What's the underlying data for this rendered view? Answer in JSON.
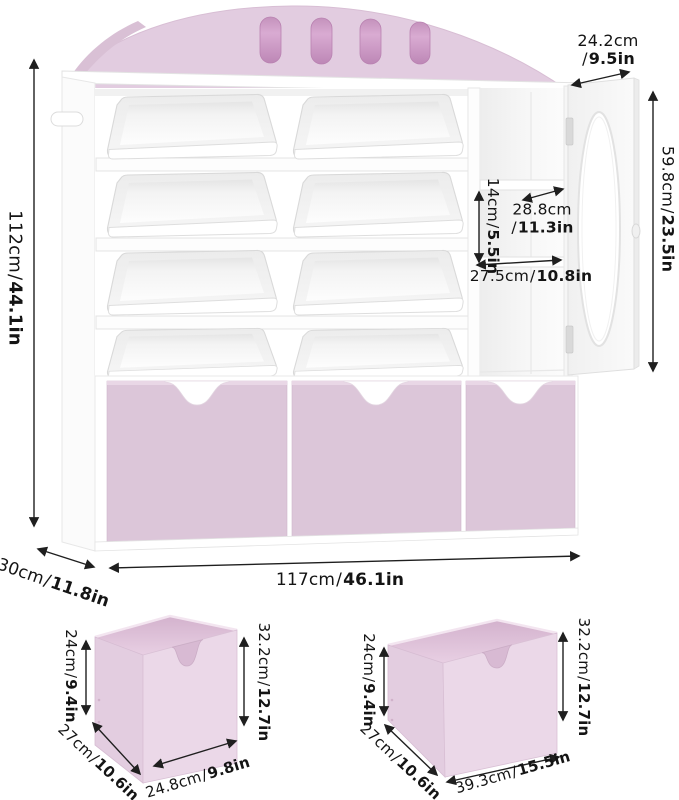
{
  "separator": "/",
  "colors": {
    "arch_pink": "#e2cce0",
    "cutout_pink": "#d4a9ce",
    "drawer_pink": "#dcc6d9",
    "box_front_pink": "#ebd8e8",
    "box_side_pink": "#e3cde0",
    "box_interior_pink": "#d8bad3",
    "dimension_line": "#1f1f1f",
    "unit_white": "#ffffff"
  },
  "main_unit": {
    "overall_height": {
      "metric": "112cm",
      "imperial": "44.1in"
    },
    "top_depth": {
      "metric": "24.2cm",
      "imperial": "9.5in"
    },
    "door_height": {
      "metric": "59.8cm",
      "imperial": "23.5in"
    },
    "cubby_height": {
      "metric": "14cm",
      "imperial": "5.5in"
    },
    "shelf_depth": {
      "metric": "28.8cm",
      "imperial": "11.3in"
    },
    "cabinet_width": {
      "metric": "27.5cm",
      "imperial": "10.8in"
    },
    "base_depth": {
      "metric": "30cm",
      "imperial": "11.8in"
    },
    "overall_width": {
      "metric": "117cm",
      "imperial": "46.1in"
    }
  },
  "small_drawer": {
    "front_height": {
      "metric": "24cm",
      "imperial": "9.4in"
    },
    "back_height": {
      "metric": "32.2cm",
      "imperial": "12.7in"
    },
    "depth": {
      "metric": "27cm",
      "imperial": "10.6in"
    },
    "width": {
      "metric": "24.8cm",
      "imperial": "9.8in"
    }
  },
  "wide_drawer": {
    "front_height": {
      "metric": "24cm",
      "imperial": "9.4in"
    },
    "back_height": {
      "metric": "32.2cm",
      "imperial": "12.7in"
    },
    "depth": {
      "metric": "27cm",
      "imperial": "10.6in"
    },
    "width": {
      "metric": "39.3cm",
      "imperial": "15.5in"
    }
  }
}
